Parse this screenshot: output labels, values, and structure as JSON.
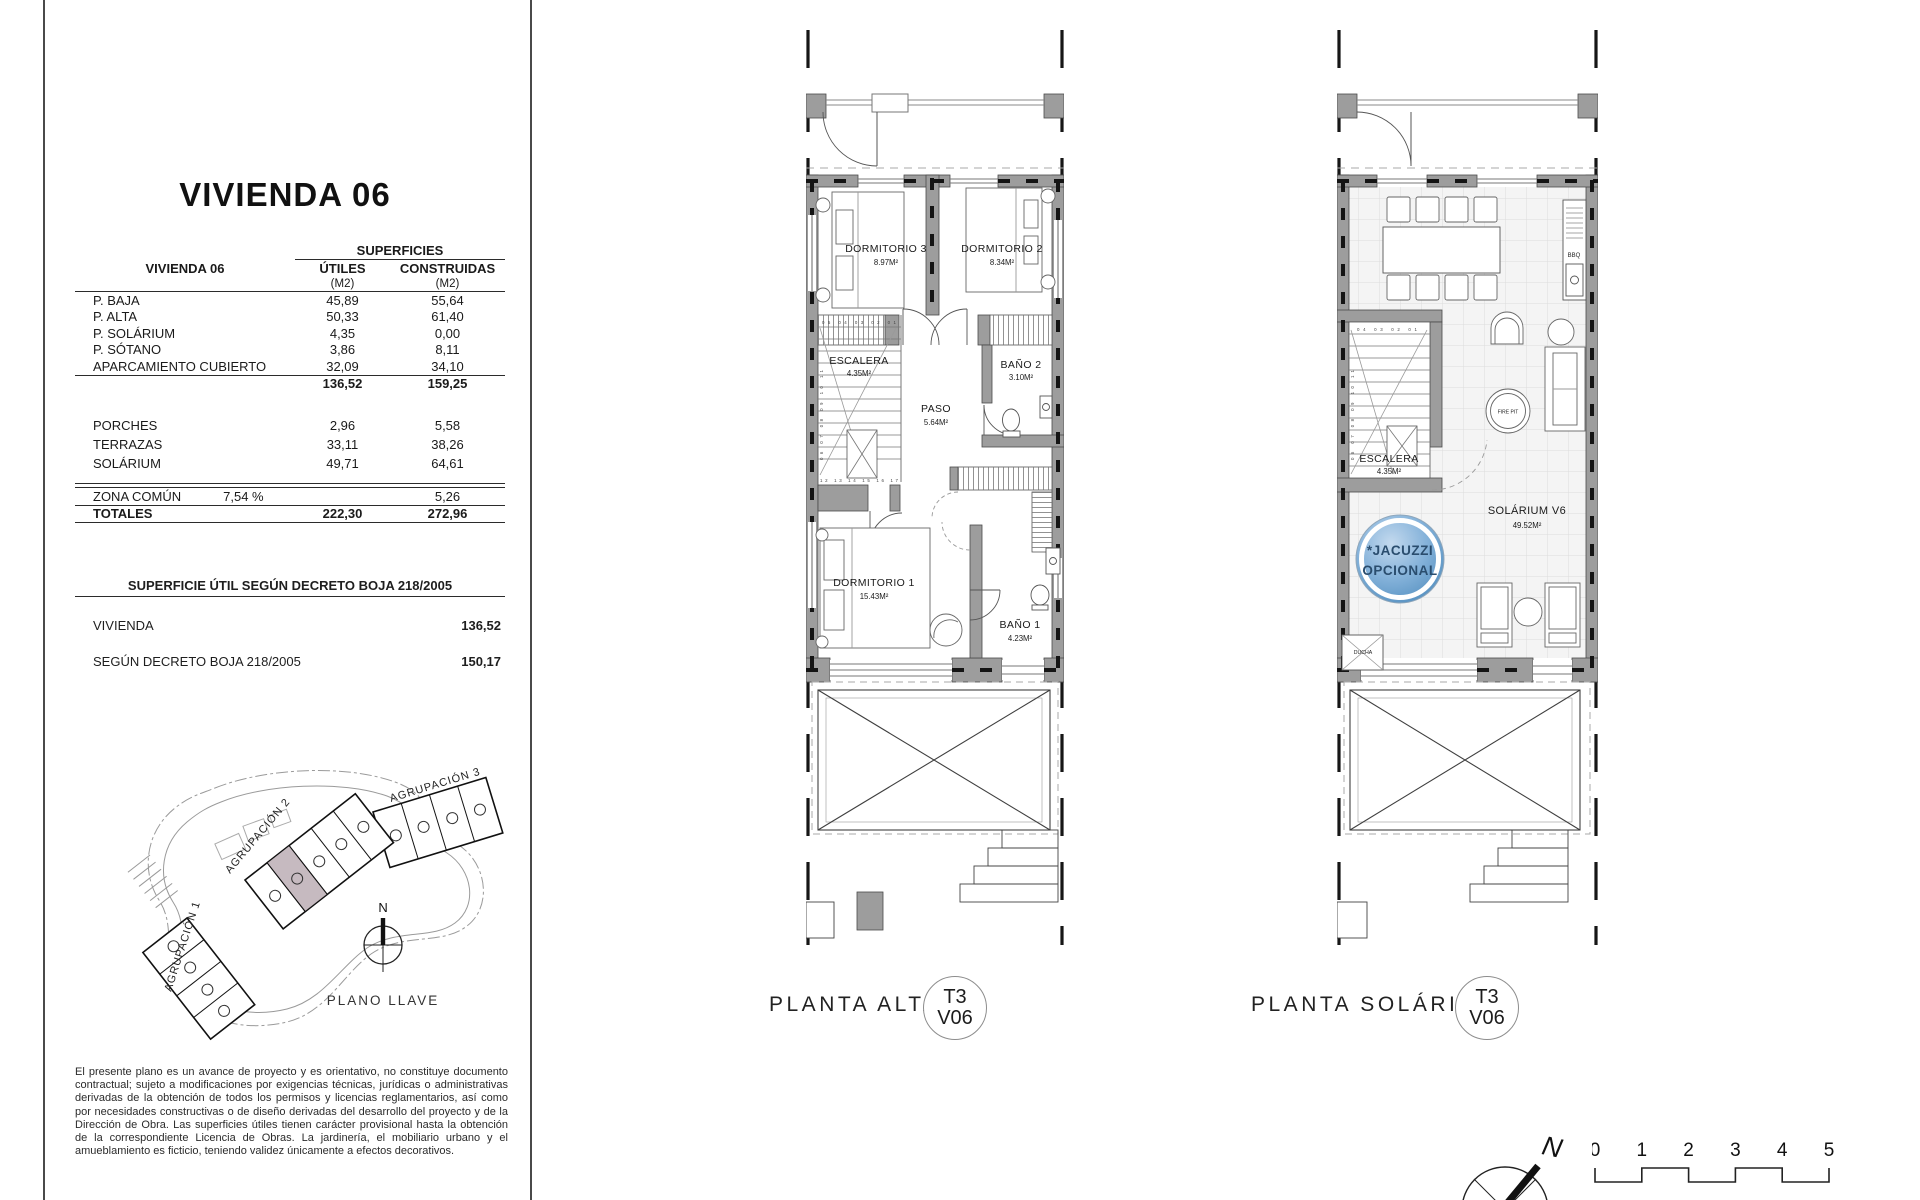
{
  "page": {
    "title": "VIVIENDA 06"
  },
  "surfaces_table": {
    "group_header": "SUPERFICIES",
    "row_header": "VIVIENDA 06",
    "col_utiles": "ÚTILES",
    "col_construidas": "CONSTRUIDAS",
    "unit_utiles": "(M2)",
    "unit_construidas": "(M2)",
    "rows": [
      {
        "label": "P. BAJA",
        "utiles": "45,89",
        "construidas": "55,64"
      },
      {
        "label": "P. ALTA",
        "utiles": "50,33",
        "construidas": "61,40"
      },
      {
        "label": "P. SOLÁRIUM",
        "utiles": "4,35",
        "construidas": "0,00"
      },
      {
        "label": "P. SÓTANO",
        "utiles": "3,86",
        "construidas": "8,11"
      },
      {
        "label": "APARCAMIENTO CUBIERTO",
        "utiles": "32,09",
        "construidas": "34,10"
      }
    ],
    "subtotal_utiles": "136,52",
    "subtotal_construidas": "159,25",
    "rows_outdoor": [
      {
        "label": "PORCHES",
        "utiles": "2,96",
        "construidas": "5,58"
      },
      {
        "label": "TERRAZAS",
        "utiles": "33,11",
        "construidas": "38,26"
      },
      {
        "label": "SOLÁRIUM",
        "utiles": "49,71",
        "construidas": "64,61"
      }
    ],
    "zona_comun_label": "ZONA COMÚN",
    "zona_comun_percent": "7,54 %",
    "zona_comun_construidas": "5,26",
    "totales_label": "TOTALES",
    "totales_utiles": "222,30",
    "totales_construidas": "272,96"
  },
  "decreto": {
    "heading": "SUPERFICIE ÚTIL SEGÚN DECRETO BOJA 218/2005",
    "row1_label": "VIVIENDA",
    "row1_value": "136,52",
    "row2_label": "SEGÚN DECRETO BOJA 218/2005",
    "row2_value": "150,17"
  },
  "site_plan": {
    "labels": {
      "agrupacion1": "AGRUPACIÓN 1",
      "agrupacion2": "AGRUPACIÓN 2",
      "agrupacion3": "AGRUPACIÓN 3"
    },
    "north": "N",
    "caption": "PLANO LLAVE"
  },
  "disclaimer": "El presente plano es un avance de proyecto y es orientativo, no constituye documento contractual; sujeto a modificaciones por exigencias técnicas, jurídicas o administrativas derivadas de la obtención de todos los permisos y licencias reglamentarios, así como por necesidades constructivas o de diseño derivadas del desarrollo del proyecto y de la Dirección de Obra. Las superficies útiles tienen carácter provisional hasta la obtención de la correspondiente Licencia de Obras. La jardinería, el mobiliario urbano y el amueblamiento es ficticio, teniendo validez únicamente a efectos decorativos.",
  "planta_alta": {
    "caption": "PLANTA ALTA",
    "badge_top": "T3",
    "badge_bottom": "V06",
    "rooms": {
      "dormitorio3": {
        "name": "DORMITORIO 3",
        "area": "8.97M²"
      },
      "dormitorio2": {
        "name": "DORMITORIO 2",
        "area": "8.34M²"
      },
      "escalera": {
        "name": "ESCALERA",
        "area": "4.35M²"
      },
      "paso": {
        "name": "PASO",
        "area": "5.64M²"
      },
      "bano2": {
        "name": "BAÑO 2",
        "area": "3.10M²"
      },
      "dormitorio1": {
        "name": "DORMITORIO 1",
        "area": "15.43M²"
      },
      "bano1": {
        "name": "BAÑO 1",
        "area": "4.23M²"
      }
    },
    "stair_numbers": {
      "top": "05 04 03 02 01",
      "side": "06 07 08 09 10 11",
      "bottom": "12 13 14 15 16 17"
    }
  },
  "planta_solarium": {
    "caption": "PLANTA SOLÁRIUM",
    "badge_top": "T3",
    "badge_bottom": "V06",
    "rooms": {
      "escalera": {
        "name": "ESCALERA",
        "area": "4.35M²"
      },
      "solarium": {
        "name": "SOLÁRIUM V6",
        "area": "49.52M²"
      }
    },
    "features": {
      "jacuzzi_line1": "*JACUZZI",
      "jacuzzi_line2": "OPCIONAL",
      "bbq": "BBQ",
      "firepit": "FIRE PIT",
      "ducha": "DUCHA"
    },
    "stair_numbers": {
      "top": "04 03 02 01",
      "side": "06 07 08 09 10 11",
      "bottom": "12 13 14 15 16 17"
    }
  },
  "compass": {
    "north": "N"
  },
  "scale_bar": {
    "ticks": [
      "0",
      "1",
      "2",
      "3",
      "4",
      "5"
    ]
  },
  "colors": {
    "wall": "#9d9d9d",
    "jacuzzi_blue": "#6fa3d2",
    "highlight_unit": "#c6bac0"
  }
}
